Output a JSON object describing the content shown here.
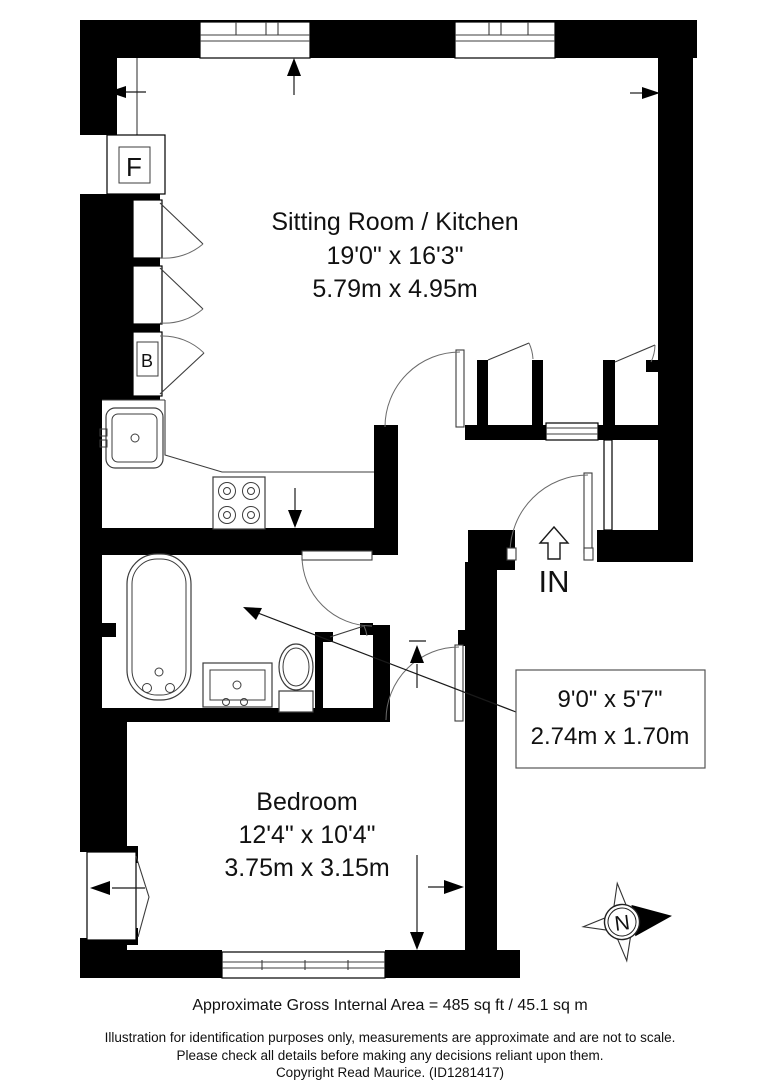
{
  "plan": {
    "rooms": {
      "sitting_room": {
        "name": "Sitting Room / Kitchen",
        "imperial": "19'0\" x 16'3\"",
        "metric": "5.79m x 4.95m"
      },
      "bedroom": {
        "name": "Bedroom",
        "imperial": "12'4\" x 10'4\"",
        "metric": "3.75m x 3.15m"
      },
      "bathroom": {
        "imperial": "9'0\" x 5'7\"",
        "metric": "2.74m x 1.70m"
      }
    },
    "entrance_label": "IN",
    "fixtures": {
      "fridge": "F",
      "boiler": "B"
    },
    "compass_north": "N"
  },
  "footer": {
    "area_line": "Approximate Gross Internal Area = 485 sq ft / 45.1 sq m",
    "disclaimer_line1": "Illustration for identification purposes only, measurements are approximate and are not to scale.",
    "disclaimer_line2": "Please check all details before making any decisions reliant upon them.",
    "copyright_line": "Copyright Read Maurice. (ID1281417)"
  },
  "colors": {
    "wall": "#000000",
    "background": "#ffffff"
  }
}
